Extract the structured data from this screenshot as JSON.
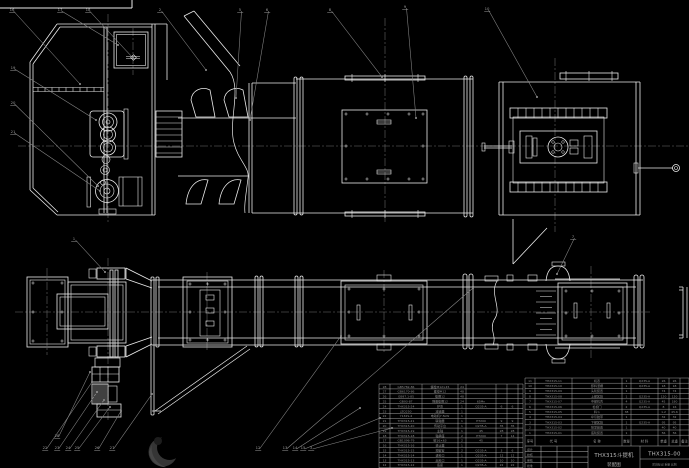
{
  "drawing": {
    "type": "CAD assembly drawing, white lines on black",
    "views": [
      "side elevation (top)",
      "plan view (bottom)"
    ]
  },
  "title_block": {
    "product": "THX315斗提机",
    "sheet_name": "装配图",
    "drawing_no": "THX315-00",
    "scale_strip": "阶段标记  重量  比例",
    "signatures": [
      "设计",
      "校核",
      "审核",
      "批准"
    ]
  },
  "bom_right": {
    "headers": [
      "序号",
      "代  号",
      "名  称",
      "数量",
      "材  料",
      "单重",
      "总重",
      "备注"
    ],
    "rows": [
      [
        "11",
        "THX315-11",
        "机罩",
        "1",
        "Q235-A",
        "26",
        "26",
        ""
      ],
      [
        "10",
        "THX315-10",
        "卸料溜槽",
        "1",
        "Q235-A",
        "18",
        "18",
        ""
      ],
      [
        "9",
        "THX315-09",
        "头轮装置",
        "1",
        "",
        "74",
        "74",
        ""
      ],
      [
        "8",
        "THX315-08",
        "上部区段",
        "1",
        "Q235-A",
        "120",
        "120",
        ""
      ],
      [
        "7",
        "THX315-07",
        "中部机壳",
        "4",
        "Q235-A",
        "45",
        "180",
        ""
      ],
      [
        "6",
        "THX315-06",
        "检视门",
        "2",
        "Q235-A",
        "8",
        "16",
        ""
      ],
      [
        "5",
        "THX315-05",
        "料斗",
        "38",
        "",
        "1.2",
        "45.6",
        ""
      ],
      [
        "4",
        "THX315-04",
        "牵引胶带",
        "1",
        "",
        "32",
        "32",
        ""
      ],
      [
        "3",
        "THX315-03",
        "下部区段",
        "1",
        "Q235-A",
        "95",
        "95",
        ""
      ],
      [
        "2",
        "THX315-02",
        "张紧装置",
        "1",
        "",
        "40",
        "40",
        ""
      ],
      [
        "1",
        "THX315-01",
        "底轮装置",
        "1",
        "",
        "56",
        "56",
        ""
      ]
    ]
  },
  "bom_left": {
    "rows": [
      [
        "28",
        "GB5782-86",
        "螺栓M12×45",
        "24",
        "",
        "",
        ""
      ],
      [
        "27",
        "GB6170-86",
        "螺母M12",
        "48",
        "",
        "",
        ""
      ],
      [
        "26",
        "GB97.1-85",
        "垫圈12",
        "48",
        "",
        "",
        ""
      ],
      [
        "25",
        "GB93-87",
        "弹簧垫圈12",
        "24",
        "65Mn",
        "",
        ""
      ],
      [
        "24",
        "THX315-24",
        "护罩",
        "1",
        "Q235-A",
        "6",
        "6"
      ],
      [
        "23",
        "JZQ250",
        "减速器",
        "1",
        "",
        "",
        ""
      ],
      [
        "22",
        "Y132S-4",
        "电动机7.5kW",
        "1",
        "",
        "",
        ""
      ],
      [
        "21",
        "THX315-21",
        "联轴器",
        "1",
        "HT200",
        "9",
        "9"
      ],
      [
        "20",
        "THX315-20",
        "传动平台",
        "1",
        "Q235-A",
        "35",
        "35"
      ],
      [
        "19",
        "THX315-19",
        "主轴",
        "1",
        "45",
        "28",
        "28"
      ],
      [
        "18",
        "THX315-18",
        "轴承座",
        "2",
        "HT200",
        "7",
        "14"
      ],
      [
        "17",
        "GB1096-79",
        "键16×63",
        "2",
        "45",
        "",
        ""
      ],
      [
        "16",
        "THX315-16",
        "逆止器",
        "1",
        "",
        "",
        ""
      ],
      [
        "15",
        "THX315-15",
        "观察窗",
        "2",
        "Q235-A",
        "3",
        "6"
      ],
      [
        "14",
        "THX315-14",
        "进料口",
        "1",
        "Q235-A",
        "12",
        "12"
      ],
      [
        "13",
        "THX315-13",
        "出料口",
        "1",
        "Q235-A",
        "10",
        "10"
      ],
      [
        "12",
        "THX315-12",
        "底座",
        "1",
        "Q235-A",
        "22",
        "22"
      ]
    ]
  },
  "callouts": [
    {
      "n": "16",
      "x": 12,
      "y": 9,
      "tx": 80,
      "ty": 84
    },
    {
      "n": "17",
      "x": 60,
      "y": 9,
      "tx": 118,
      "ty": 45
    },
    {
      "n": "18",
      "x": 88,
      "y": 9,
      "tx": 133,
      "ty": 58
    },
    {
      "n": "2",
      "x": 160,
      "y": 9,
      "tx": 206,
      "ty": 70
    },
    {
      "n": "5",
      "x": 240,
      "y": 9,
      "tx": 236,
      "ty": 98
    },
    {
      "n": "6",
      "x": 267,
      "y": 9,
      "tx": 250,
      "ty": 120
    },
    {
      "n": "8",
      "x": 330,
      "y": 9,
      "tx": 382,
      "ty": 77
    },
    {
      "n": "9",
      "x": 405,
      "y": 6,
      "tx": 416,
      "ty": 118
    },
    {
      "n": "10",
      "x": 487,
      "y": 8,
      "tx": 537,
      "ty": 97
    },
    {
      "n": "19",
      "x": 13,
      "y": 67,
      "tx": 96,
      "ty": 120
    },
    {
      "n": "20",
      "x": 13,
      "y": 102,
      "tx": 98,
      "ty": 186
    },
    {
      "n": "21",
      "x": 13,
      "y": 131,
      "tx": 100,
      "ty": 191
    },
    {
      "n": "1",
      "x": 74,
      "y": 238,
      "tx": 105,
      "ty": 272
    },
    {
      "n": "7",
      "x": 573,
      "y": 236,
      "tx": 557,
      "ty": 274
    },
    {
      "n": "28",
      "x": 57,
      "y": 435,
      "tx": 90,
      "ty": 372
    },
    {
      "n": "22",
      "x": 45,
      "y": 447,
      "tx": 92,
      "ty": 382
    },
    {
      "n": "23",
      "x": 57,
      "y": 447,
      "tx": 97,
      "ty": 392
    },
    {
      "n": "24",
      "x": 68,
      "y": 447,
      "tx": 104,
      "ty": 400
    },
    {
      "n": "25",
      "x": 77,
      "y": 447,
      "tx": 110,
      "ty": 407
    },
    {
      "n": "26",
      "x": 97,
      "y": 447,
      "tx": 121,
      "ty": 411
    },
    {
      "n": "27",
      "x": 112,
      "y": 447,
      "tx": 152,
      "ty": 394
    },
    {
      "n": "12",
      "x": 258,
      "y": 447,
      "tx": 341,
      "ty": 336
    },
    {
      "n": "13",
      "x": 285,
      "y": 447,
      "tx": 473,
      "ty": 288
    },
    {
      "n": "14",
      "x": 295,
      "y": 447,
      "tx": 360,
      "ty": 408
    },
    {
      "n": "15",
      "x": 303,
      "y": 447,
      "tx": 380,
      "ty": 418
    },
    {
      "n": "3",
      "x": 311,
      "y": 447,
      "tx": 392,
      "ty": 428
    }
  ],
  "colors": {
    "background": "#000000",
    "main_line": "#eaeaea",
    "thin_line": "#cfcfcf",
    "gray_line": "#8a8a8a",
    "centerline": "#6f6f6f",
    "table_grid": "#b5b5b5",
    "table_text": "#8f8f8f",
    "watermark": "#333333"
  }
}
